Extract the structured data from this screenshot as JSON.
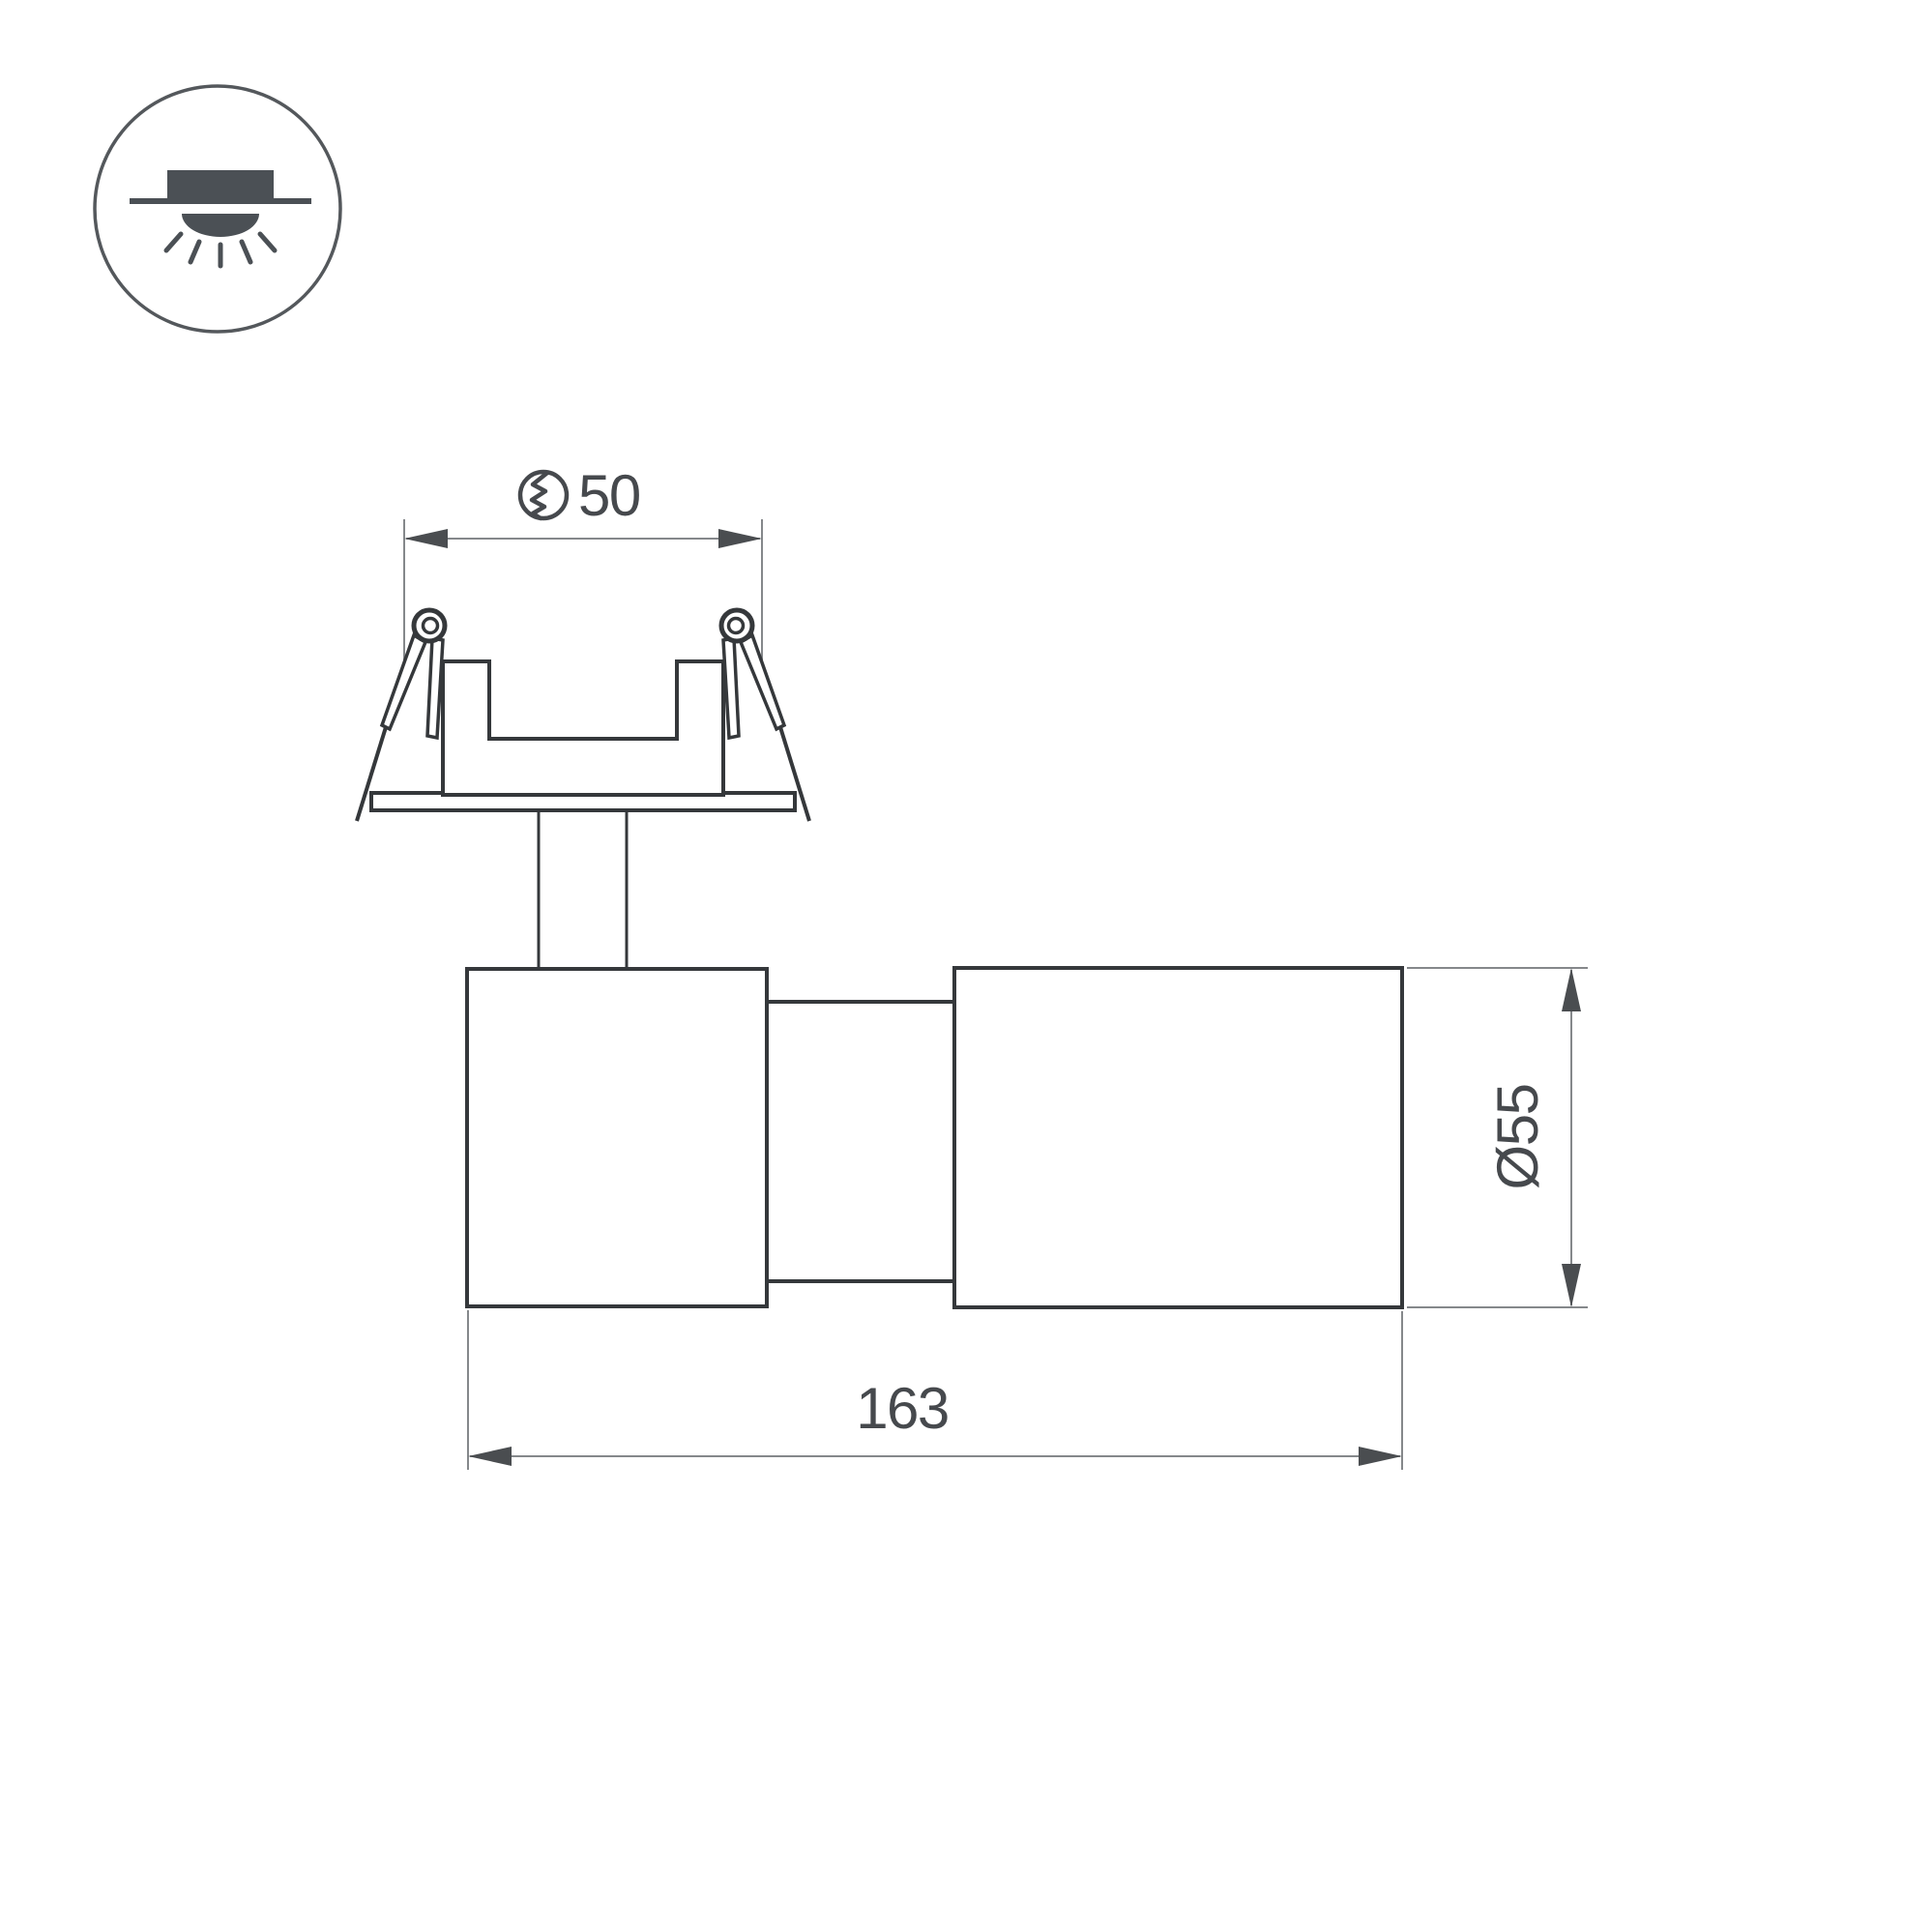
{
  "legend_icon": {
    "name": "recessed-downlight-icon",
    "parts": [
      "fixture-body",
      "ceiling-line",
      "light-dome",
      "light-rays"
    ]
  },
  "drawing": {
    "type": "technical-dimension-drawing",
    "views": [
      "mounting-ring-with-spring-clips",
      "spotlight-body-side-view"
    ]
  },
  "dimensions": {
    "cutout": {
      "value": "50",
      "symbol": "cutout-hole-icon"
    },
    "length": {
      "value": "163"
    },
    "diameter": {
      "value": "Ø55"
    }
  },
  "colors": {
    "outline": "#35383b",
    "dimension_line": "#85888b",
    "arrow": "#4a4d50",
    "text": "#46494d",
    "icon": "#4b5055",
    "background": "#ffffff"
  }
}
